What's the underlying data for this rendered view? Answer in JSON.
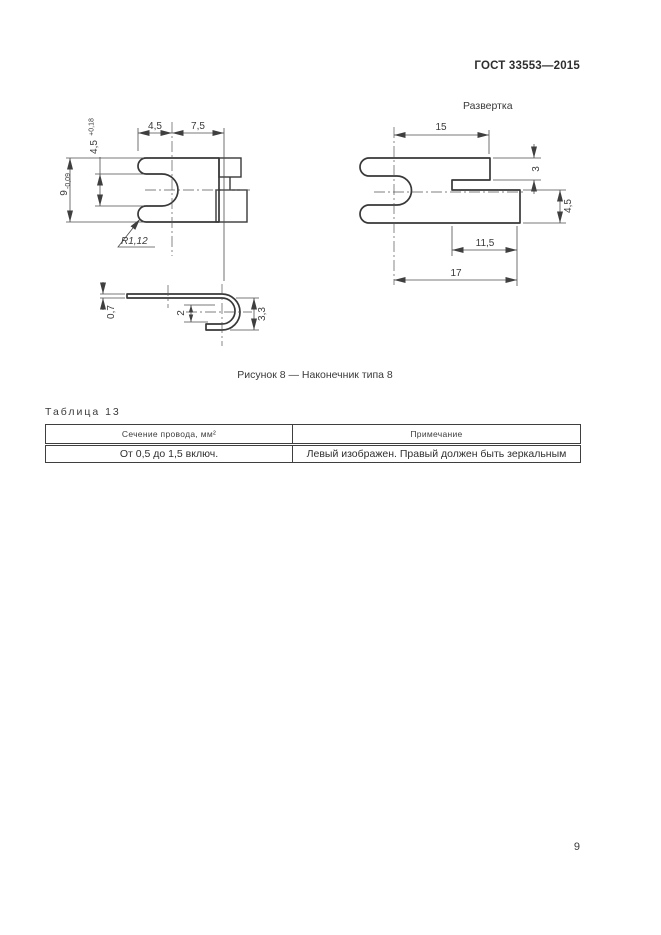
{
  "page": {
    "standard": "ГОСТ 33553—2015",
    "number": "9"
  },
  "figure": {
    "caption": "Рисунок 8 — Наконечник типа 8",
    "flat_pattern_label": "Развертка",
    "top_view": {
      "width_a": "4,5",
      "width_b": "7,5",
      "slot": "4,5",
      "slot_tol": "+0,18",
      "height": "9",
      "height_tol": "-0,09",
      "radius": "R1,12"
    },
    "flat_view": {
      "length": "15",
      "step": "3",
      "tab_height": "4,5",
      "tab_width": "11,5",
      "total": "17"
    },
    "side_view": {
      "thickness": "0,7",
      "inner": "2",
      "outer": "3,3"
    }
  },
  "table": {
    "title": "Таблица 13",
    "columns": [
      "Сечение провода, мм²",
      "Примечание"
    ],
    "rows": [
      [
        "От 0,5 до 1,5 включ.",
        "Левый изображен. Правый должен быть зеркальным"
      ]
    ]
  }
}
